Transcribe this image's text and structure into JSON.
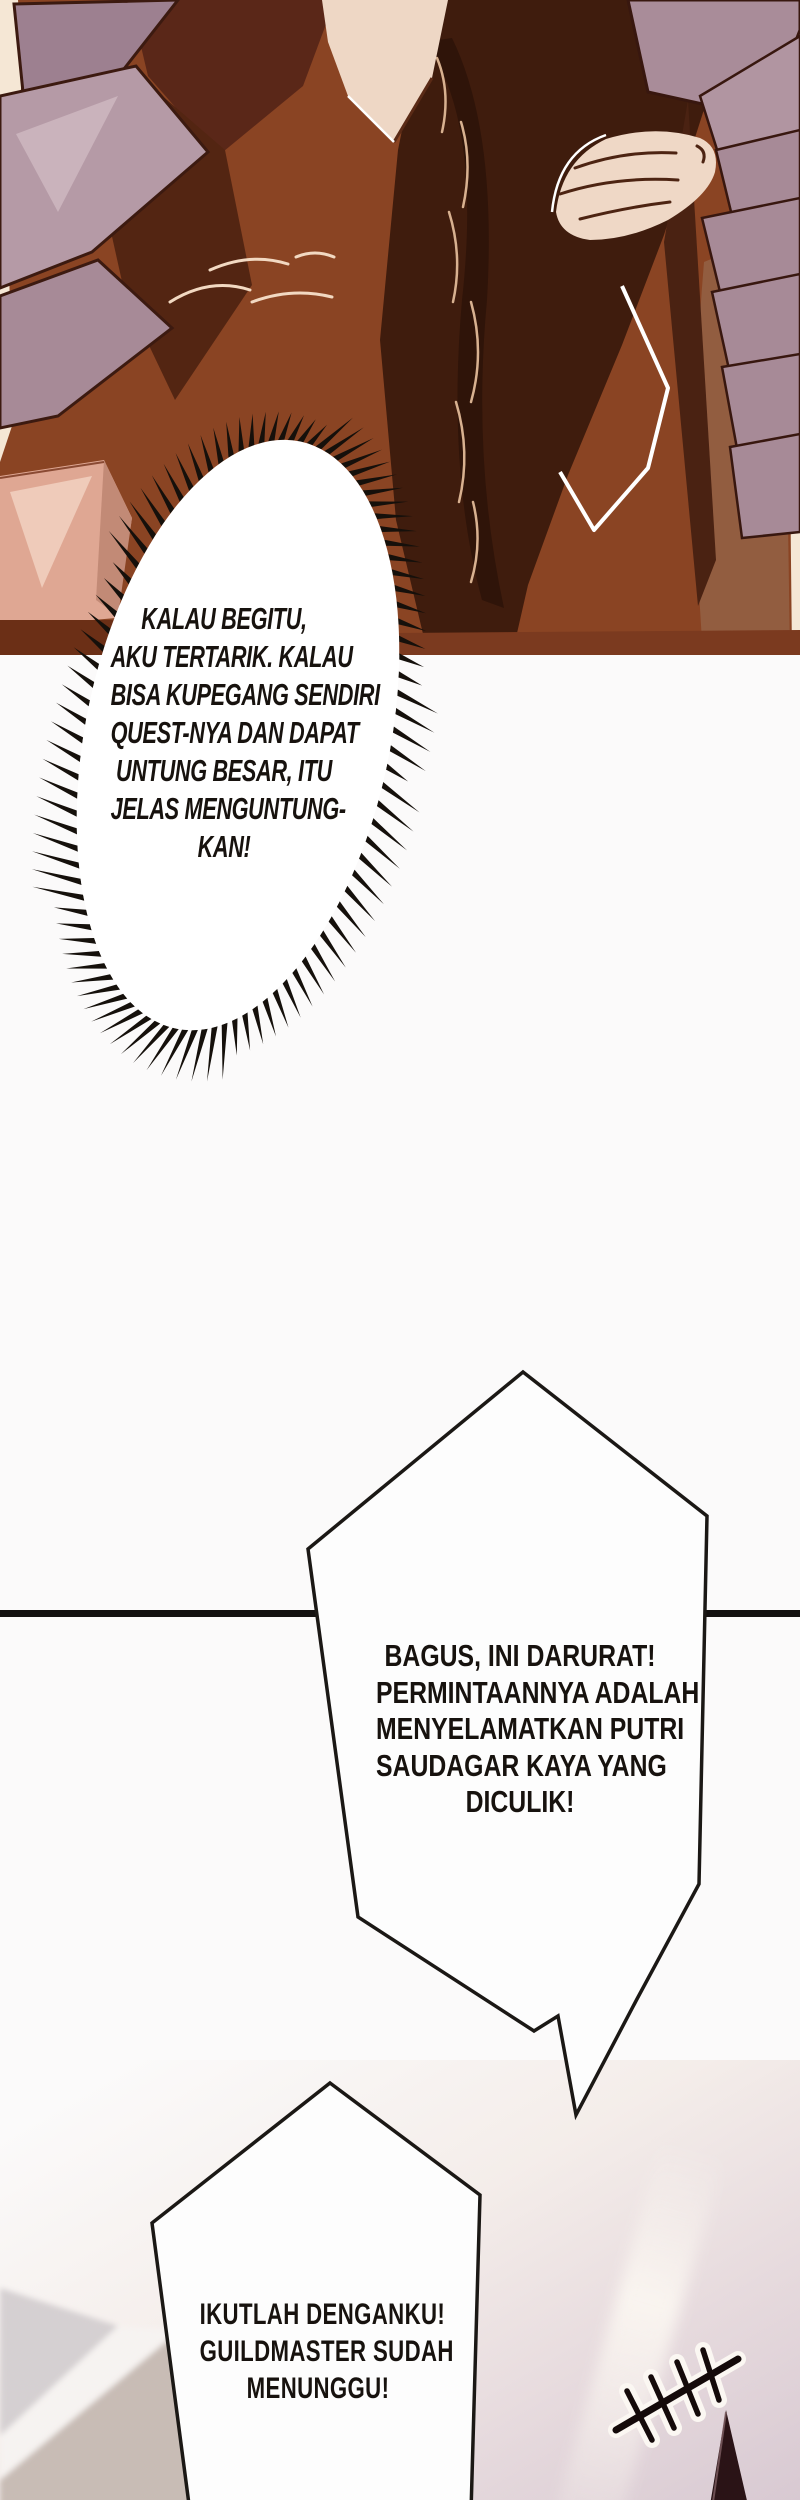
{
  "bubbles": {
    "burst": {
      "lines": [
        "KALAU BEGITU,",
        "AKU TERTARIK. KALAU",
        "BISA KUPEGANG SENDIRI",
        "QUEST-NYA DAN DAPAT",
        "UNTUNG BESAR, ITU",
        "JELAS MENGUNTUNG-",
        "KAN!"
      ]
    },
    "quest": {
      "lines": [
        "BAGUS, INI DARURAT!",
        "PERMINTAANNYA ADALAH",
        "MENYELAMATKAN PUTRI",
        "SAUDAGAR KAYA YANG",
        "DICULIK!"
      ]
    },
    "follow": {
      "lines": [
        "IKUTLAH DENGANKU!",
        "GUILDMASTER SUDAH",
        "MENUNGGU!"
      ]
    }
  },
  "palette": {
    "panel_cream": "#f5e7d5",
    "coat_rust": "#8a4423",
    "coat_dark": "#3f1c0d",
    "armor_mauve": "#b59aa6",
    "skin": "#eed7c5",
    "pink_plate": "#dfa793",
    "ink_black": "#17120e",
    "bubble_white": "#fefefe",
    "sky_lavender": "#d8c9d2",
    "roof_gray": "#d5d0d2",
    "roof_beige": "#c8bcb5"
  }
}
